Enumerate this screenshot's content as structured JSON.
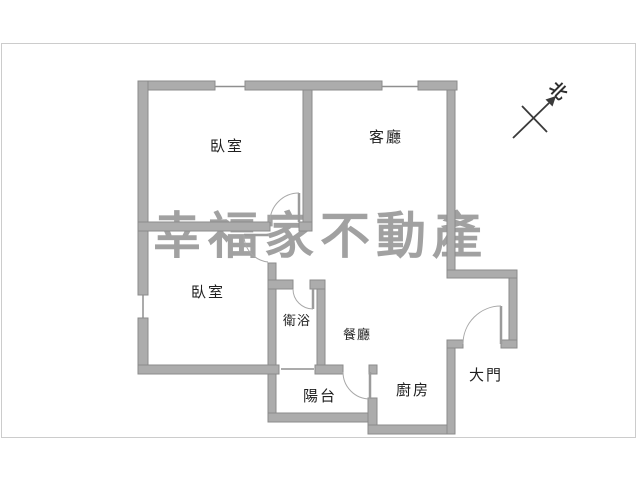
{
  "watermark": {
    "text": "幸福家不動產"
  },
  "compass": {
    "label": "北"
  },
  "rooms": {
    "bedroom1": {
      "label": "臥室"
    },
    "living": {
      "label": "客廳"
    },
    "bedroom2": {
      "label": "臥室"
    },
    "bathroom": {
      "label": "衛浴"
    },
    "dining": {
      "label": "餐廳"
    },
    "balcony": {
      "label": "陽台"
    },
    "kitchen": {
      "label": "廚房"
    },
    "entrance": {
      "label": "大門"
    }
  },
  "colors": {
    "wall_fill": "#acacac",
    "wall_edge": "#8b8b8b",
    "window_line": "#8f8f8f",
    "door_arc": "#9b9b9b",
    "label_text": "#1f1f1f",
    "frame_border": "#cccccc",
    "watermark_gray": "#a1a1a1",
    "compass_ink": "#3a3a3a"
  }
}
